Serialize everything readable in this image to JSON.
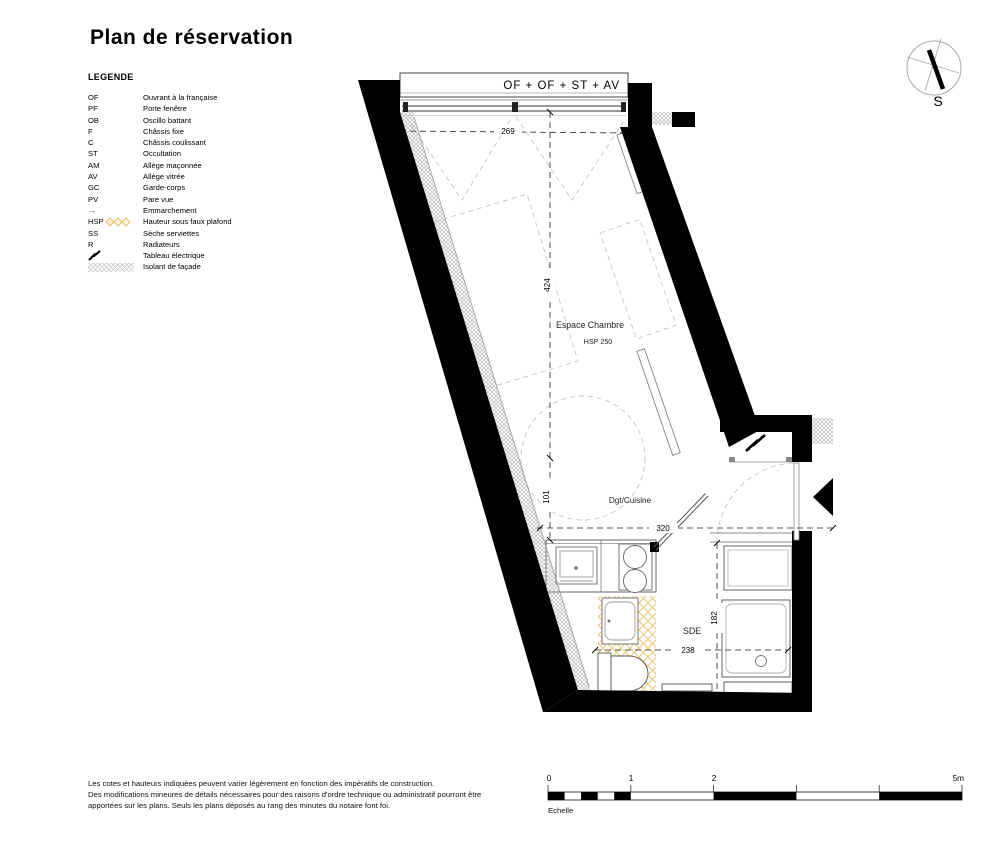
{
  "title": "Plan de réservation",
  "legend": {
    "heading": "LEGENDE",
    "items": [
      {
        "abbr": "OF",
        "label": "Ouvrant à la française"
      },
      {
        "abbr": "PF",
        "label": "Porte fenêtre"
      },
      {
        "abbr": "OB",
        "label": "Oscillo battant"
      },
      {
        "abbr": "F",
        "label": "Châssis fixe"
      },
      {
        "abbr": "C",
        "label": "Châssis coulissant"
      },
      {
        "abbr": "ST",
        "label": "Occultation"
      },
      {
        "abbr": "AM",
        "label": "Allège maçonnée"
      },
      {
        "abbr": "AV",
        "label": "Allège vitrée"
      },
      {
        "abbr": "GC",
        "label": "Garde-corps"
      },
      {
        "abbr": "PV",
        "label": "Pare vue"
      },
      {
        "abbr": "→",
        "label": "Emmarchement"
      },
      {
        "abbr": "HSP",
        "label": "Hauteur sous faux plafond",
        "symbol": "diamonds"
      },
      {
        "abbr": "SS",
        "label": "Sèche serviettes"
      },
      {
        "abbr": "R",
        "label": "Radiateurs"
      },
      {
        "abbr": "",
        "label": "Tableau électrique",
        "symbol": "lightning"
      },
      {
        "abbr": "",
        "label": "Isolant de façade",
        "symbol": "hatch"
      }
    ]
  },
  "plan": {
    "window_label": "OF + OF + ST + AV",
    "rooms": [
      {
        "name": "Espace Chambre",
        "note": "HSP 250"
      },
      {
        "name": "Dgt/Cuisine"
      },
      {
        "name": "SDE"
      }
    ],
    "dims": {
      "window_width": "269",
      "chamber_depth": "424",
      "kitchen_depth": "101",
      "hall_width": "320",
      "sde_width": "238",
      "sde_depth": "182"
    }
  },
  "compass": {
    "south": "S"
  },
  "scalebar": {
    "ticks": [
      "0",
      "1",
      "2",
      "5m"
    ],
    "caption": "Echelle"
  },
  "footer": {
    "lines": [
      "Les cotes et hauteurs indiquées peuvent varier légèrement en fonction des impératifs de construction.",
      "Des modifications mineures de détails nécessaires pour des raisons d'ordre technique ou administratif pourront être",
      "apportées sur les plans. Seuls les plans déposés au rang des minutes du notaire font foi."
    ]
  },
  "colors": {
    "wall": "#000000",
    "hsp_zone": "#ecc978",
    "furniture_dash": "#c4c4c4",
    "insulation": "#b9b9b9"
  }
}
